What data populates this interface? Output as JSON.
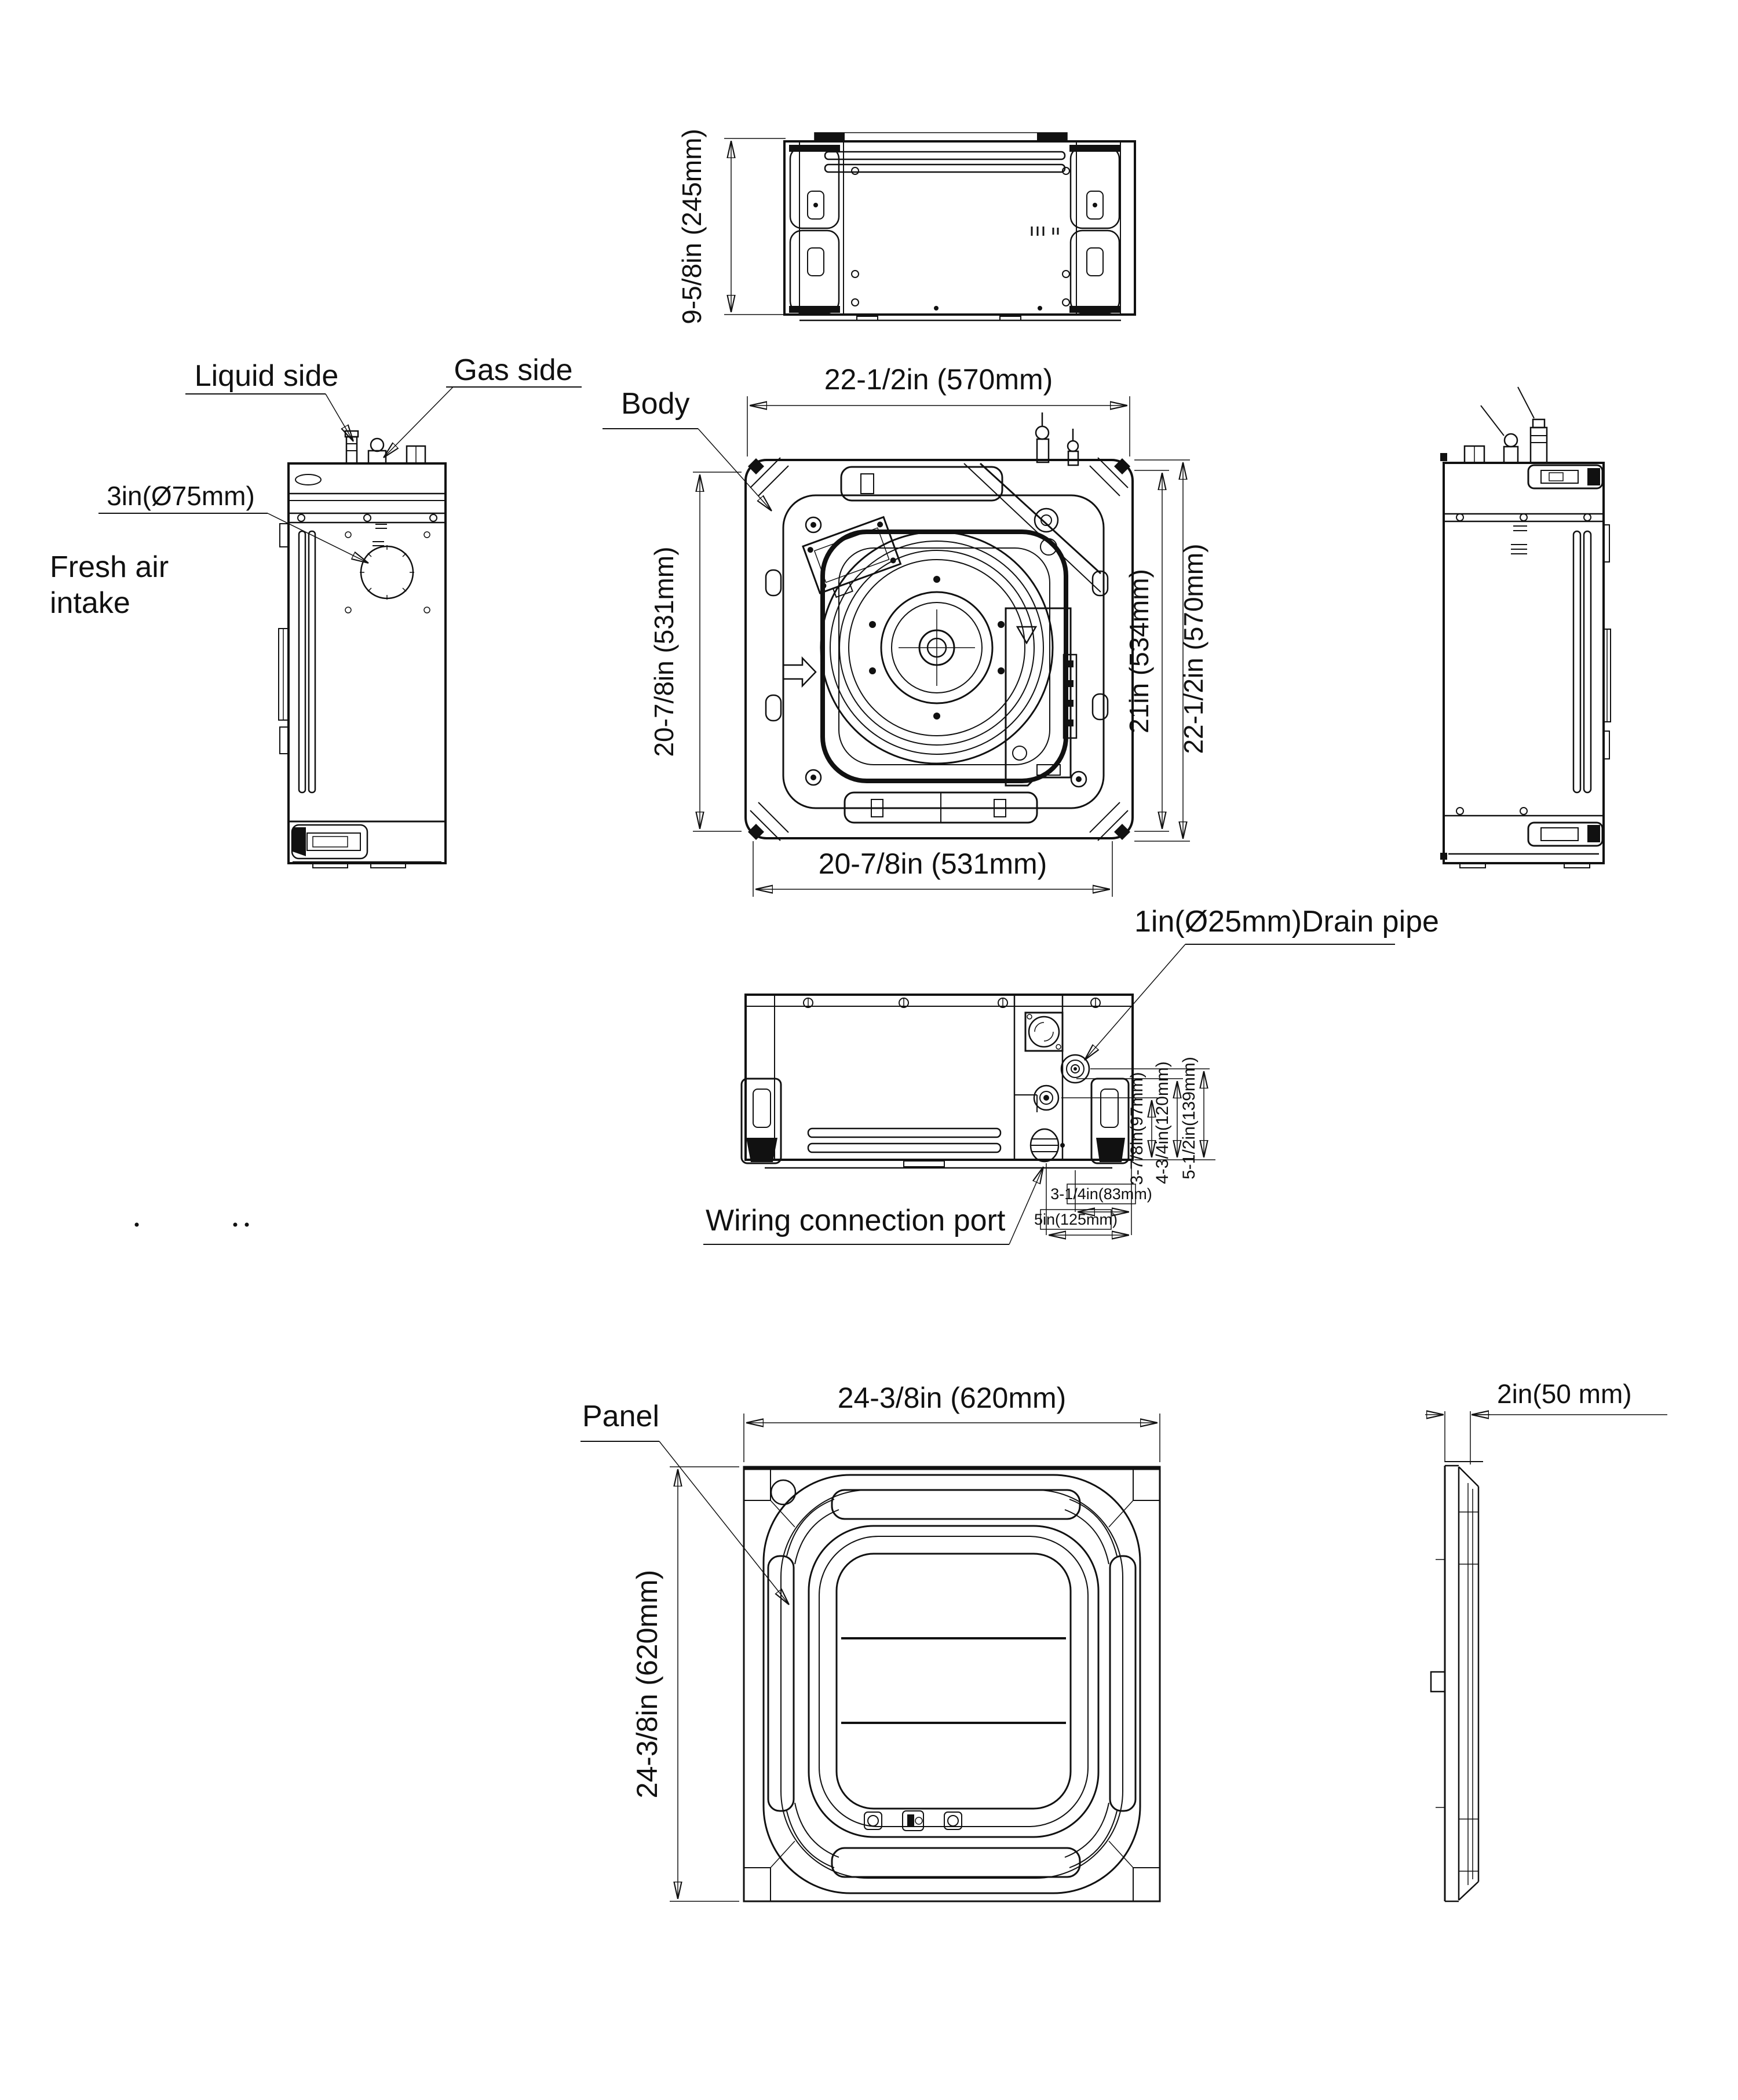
{
  "palette": {
    "line": "#111111",
    "background": "#ffffff"
  },
  "views": {
    "top": {
      "dim_height": "9-5/8in (245mm)"
    },
    "left_side": {
      "label_liquid": "Liquid side",
      "label_gas": "Gas side",
      "dim_intake": "3in(Ø75mm)",
      "label_intake_1": "Fresh air",
      "label_intake_2": "intake"
    },
    "plan": {
      "label_body": "Body",
      "dim_top": "22-1/2in (570mm)",
      "dim_left": "20-7/8in (531mm)",
      "dim_right_inner": "21in (534mm)",
      "dim_right_outer": "22-1/2in (570mm)",
      "dim_bottom": "20-7/8in (531mm)"
    },
    "front": {
      "label_drain": "1in(Ø25mm)Drain pipe",
      "label_wiring": "Wiring connection port",
      "dim_h1": "3-7/8in(97mm)",
      "dim_h2": "4-3/4in(120mm)",
      "dim_h3": "5-1/2in(139mm)",
      "dim_w1": "3-1/4in(83mm)",
      "dim_w2": "5in(125mm)"
    },
    "panel": {
      "label_panel": "Panel",
      "dim_width": "24-3/8in (620mm)",
      "dim_height": "24-3/8in (620mm)"
    },
    "panel_side": {
      "dim_depth": "2in(50 mm)"
    }
  }
}
